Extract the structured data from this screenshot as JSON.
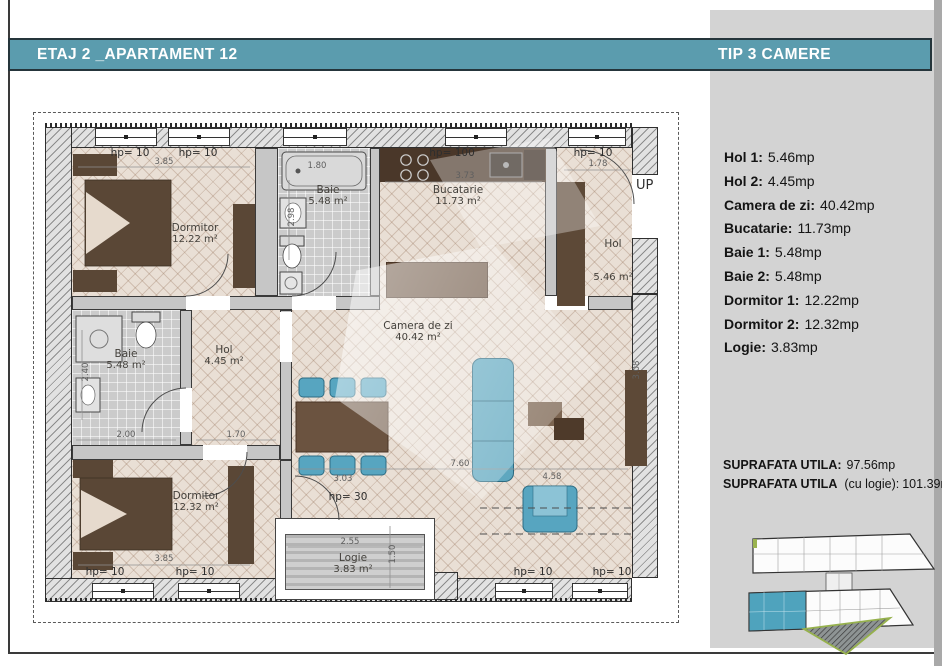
{
  "header": {
    "left_title": "ETAJ 2 _APARTAMENT 12",
    "right_title": "TIP 3 CAMERE"
  },
  "legend": {
    "items": [
      {
        "label": "Hol 1:",
        "value": "5.46mp"
      },
      {
        "label": "Hol 2:",
        "value": "4.45mp"
      },
      {
        "label": "Camera de zi:",
        "value": "40.42mp"
      },
      {
        "label": "Bucatarie:",
        "value": "11.73mp"
      },
      {
        "label": "Baie 1:",
        "value": "5.48mp"
      },
      {
        "label": "Baie 2:",
        "value": "5.48mp"
      },
      {
        "label": "Dormitor 1:",
        "value": "12.22mp"
      },
      {
        "label": "Dormitor 2:",
        "value": "12.32mp"
      },
      {
        "label": "Logie:",
        "value": "3.83mp"
      }
    ]
  },
  "totals": [
    {
      "label": "SUPRAFATA UTILA:",
      "value": "97.56mp"
    },
    {
      "label": "SUPRAFATA UTILA",
      "note": "(cu logie):",
      "value": "101.39mp"
    }
  ],
  "plan": {
    "rooms": {
      "dormitor1": {
        "name": "Dormitor",
        "area": "12.22 m²"
      },
      "baie1": {
        "name": "Baie",
        "area": "5.48 m²"
      },
      "bucatarie": {
        "name": "Bucatarie",
        "area": "11.73 m²"
      },
      "hol1": {
        "name": "Hol",
        "area": "5.46 m²"
      },
      "baie2": {
        "name": "Baie",
        "area": "5.48 m²"
      },
      "hol2": {
        "name": "Hol",
        "area": "4.45 m²"
      },
      "camera": {
        "name": "Camera de zi",
        "area": "40.42 m²"
      },
      "dormitor2": {
        "name": "Dormitor",
        "area": "12.32 m²"
      },
      "logie": {
        "name": "Logie",
        "area": "3.83 m²"
      }
    },
    "labels": {
      "hp10": "hp= 10",
      "hp100": "hp= 100",
      "hp30": "hp= 30",
      "up": "UP"
    },
    "dims": {
      "d385": "3.85",
      "d180": "1.80",
      "d298": "2.98",
      "d373": "3.73",
      "d178": "1.78",
      "d240": "2.40",
      "d200": "2.00",
      "d170": "1.70",
      "d760": "7.60",
      "d458": "4.58",
      "d303": "3.03",
      "d255": "2.55",
      "d150": "1.50",
      "d308": "3.08"
    }
  },
  "colors": {
    "accent": "#5b9cae",
    "highlight_unit": "#4fa3bd",
    "floor": "#e9dfd5"
  }
}
